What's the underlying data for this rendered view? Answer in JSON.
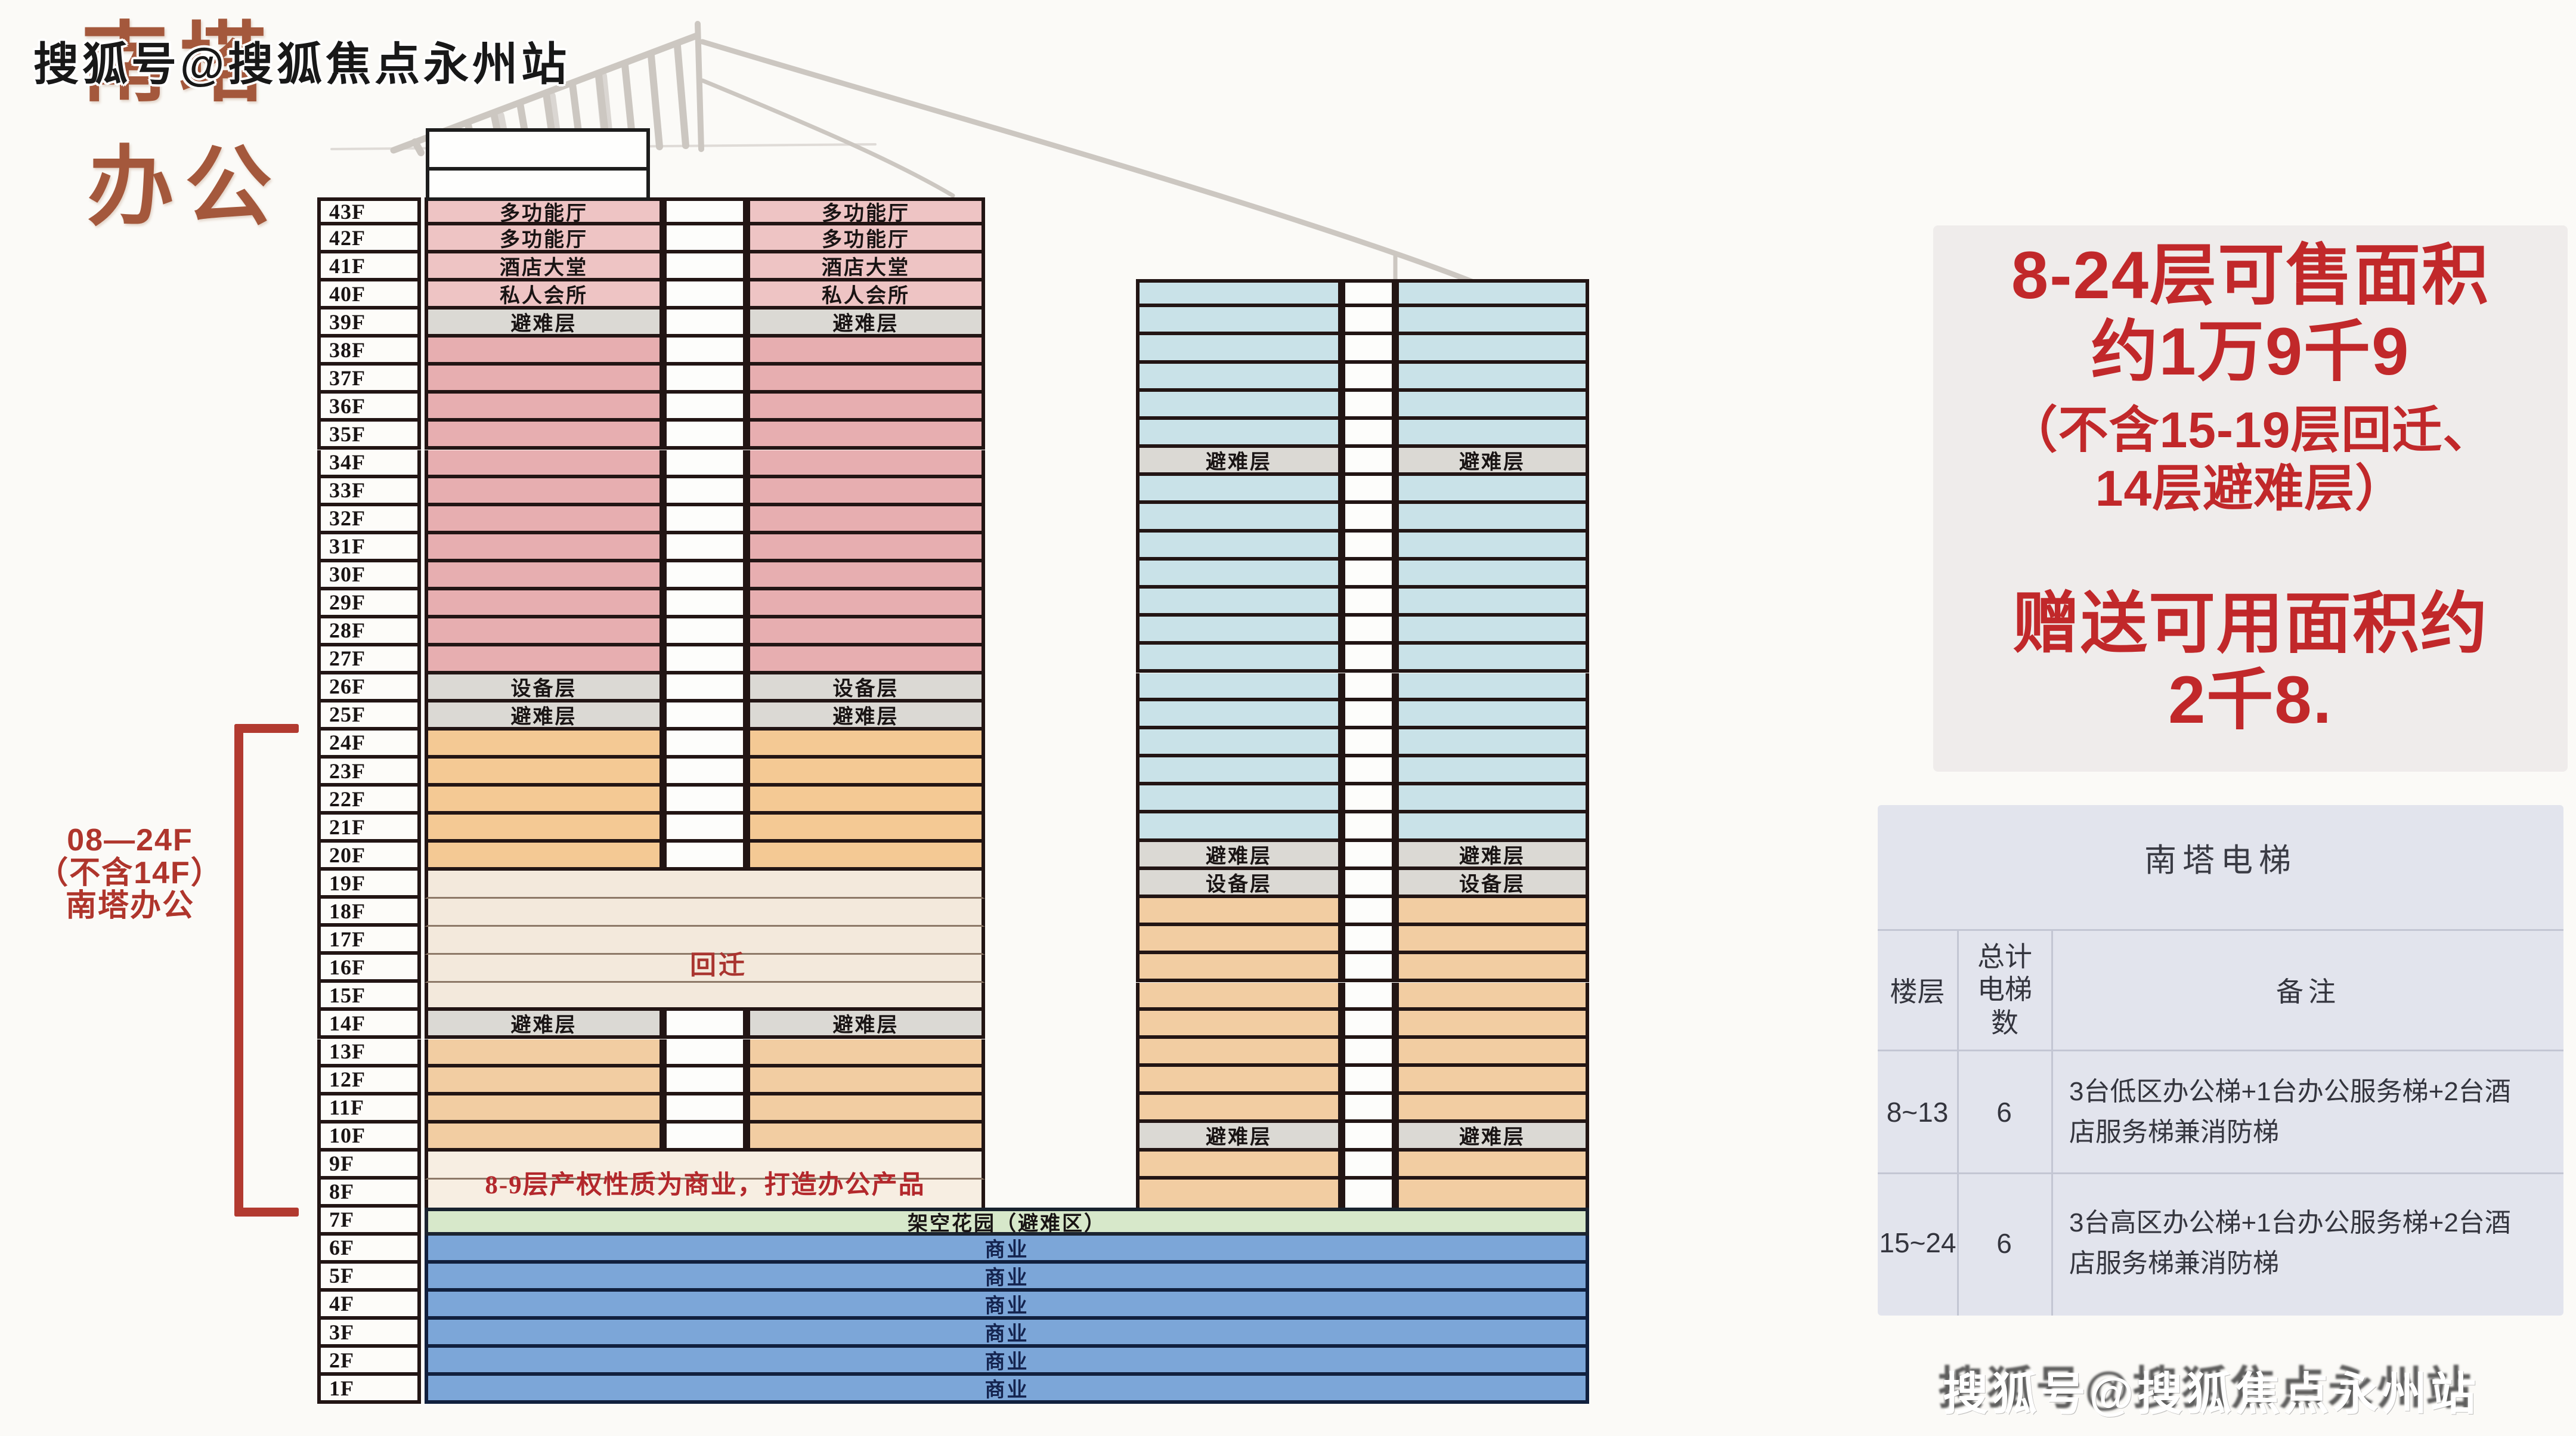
{
  "watermarks": {
    "top": "搜狐号@搜狐焦点永州站",
    "bottom": "搜狐号@搜狐焦点永州站"
  },
  "title": {
    "line1": "南塔",
    "line2": "办公"
  },
  "bracket": {
    "lines": [
      "08—24F",
      "（不含14F）",
      "南塔办公"
    ]
  },
  "overlays": {
    "huiqian": "回迁",
    "note_8_9": "8-9层产权性质为商业，打造办公产品"
  },
  "palette": {
    "border_dark": "#221514",
    "blue_border": "#11203e",
    "gap_white": "#fdfdfb",
    "pink": "#e7aeb0",
    "pink_light": "#eec4c4",
    "gray_row": "#dbd9d4",
    "orange": "#f4c994",
    "orange2": "#f2cda2",
    "beige": "#f3e9dc",
    "beige2": "#f7eee2",
    "cyan": "#c9e2e8",
    "green": "#d7e8ca",
    "blue": "#7ca6d8",
    "red_note": "#c1282a",
    "red_bracket": "#b23a30",
    "title_brown": "#a4583c",
    "beige_divider": "#8d7968"
  },
  "left_tower": {
    "floors": [
      {
        "label": "43F",
        "type": "split",
        "color": "pink_light",
        "text": "多功能厅"
      },
      {
        "label": "42F",
        "type": "split",
        "color": "pink_light",
        "text": "多功能厅"
      },
      {
        "label": "41F",
        "type": "split",
        "color": "pink_light",
        "text": "酒店大堂"
      },
      {
        "label": "40F",
        "type": "split",
        "color": "pink_light",
        "text": "私人会所"
      },
      {
        "label": "39F",
        "type": "split",
        "color": "gray_row",
        "text": "避难层"
      },
      {
        "label": "38F",
        "type": "split",
        "color": "pink",
        "text": ""
      },
      {
        "label": "37F",
        "type": "split",
        "color": "pink",
        "text": ""
      },
      {
        "label": "36F",
        "type": "split",
        "color": "pink",
        "text": ""
      },
      {
        "label": "35F",
        "type": "split",
        "color": "pink",
        "text": ""
      },
      {
        "label": "34F",
        "type": "split",
        "color": "pink",
        "text": ""
      },
      {
        "label": "33F",
        "type": "split",
        "color": "pink",
        "text": ""
      },
      {
        "label": "32F",
        "type": "split",
        "color": "pink",
        "text": ""
      },
      {
        "label": "31F",
        "type": "split",
        "color": "pink",
        "text": ""
      },
      {
        "label": "30F",
        "type": "split",
        "color": "pink",
        "text": ""
      },
      {
        "label": "29F",
        "type": "split",
        "color": "pink",
        "text": ""
      },
      {
        "label": "28F",
        "type": "split",
        "color": "pink",
        "text": ""
      },
      {
        "label": "27F",
        "type": "split",
        "color": "pink",
        "text": ""
      },
      {
        "label": "26F",
        "type": "split",
        "color": "gray_row",
        "text": "设备层"
      },
      {
        "label": "25F",
        "type": "split",
        "color": "gray_row",
        "text": "避难层"
      },
      {
        "label": "24F",
        "type": "split",
        "color": "orange",
        "text": ""
      },
      {
        "label": "23F",
        "type": "split",
        "color": "orange",
        "text": ""
      },
      {
        "label": "22F",
        "type": "split",
        "color": "orange",
        "text": ""
      },
      {
        "label": "21F",
        "type": "split",
        "color": "orange",
        "text": ""
      },
      {
        "label": "20F",
        "type": "split",
        "color": "orange",
        "text": ""
      },
      {
        "label": "19F",
        "type": "merged",
        "color": "beige",
        "text": ""
      },
      {
        "label": "18F",
        "type": "merged",
        "color": "beige",
        "text": ""
      },
      {
        "label": "17F",
        "type": "merged",
        "color": "beige",
        "text": ""
      },
      {
        "label": "16F",
        "type": "merged",
        "color": "beige",
        "text": ""
      },
      {
        "label": "15F",
        "type": "merged",
        "color": "beige",
        "text": ""
      },
      {
        "label": "14F",
        "type": "split",
        "color": "gray_row",
        "text": "避难层"
      },
      {
        "label": "13F",
        "type": "split",
        "color": "orange2",
        "text": ""
      },
      {
        "label": "12F",
        "type": "split",
        "color": "orange2",
        "text": ""
      },
      {
        "label": "11F",
        "type": "split",
        "color": "orange2",
        "text": ""
      },
      {
        "label": "10F",
        "type": "split",
        "color": "orange2",
        "text": ""
      },
      {
        "label": "9F",
        "type": "merged",
        "color": "beige2",
        "text": ""
      },
      {
        "label": "8F",
        "type": "merged",
        "color": "beige2",
        "text": ""
      },
      {
        "label": "7F",
        "type": "wide",
        "color": "green",
        "text": "架空花园（避难区）"
      },
      {
        "label": "6F",
        "type": "wide",
        "color": "blue",
        "text": "商业"
      },
      {
        "label": "5F",
        "type": "wide",
        "color": "blue",
        "text": "商业"
      },
      {
        "label": "4F",
        "type": "wide",
        "color": "blue",
        "text": "商业"
      },
      {
        "label": "3F",
        "type": "wide",
        "color": "blue",
        "text": "商业"
      },
      {
        "label": "2F",
        "type": "wide",
        "color": "blue",
        "text": "商业"
      },
      {
        "label": "1F",
        "type": "wide",
        "color": "blue",
        "text": "商业"
      }
    ]
  },
  "right_tower": {
    "rows": [
      {
        "color": "cyan",
        "text": ""
      },
      {
        "color": "cyan",
        "text": ""
      },
      {
        "color": "cyan",
        "text": ""
      },
      {
        "color": "cyan",
        "text": ""
      },
      {
        "color": "cyan",
        "text": ""
      },
      {
        "color": "cyan",
        "text": ""
      },
      {
        "color": "gray_row",
        "text": "避难层"
      },
      {
        "color": "cyan",
        "text": ""
      },
      {
        "color": "cyan",
        "text": ""
      },
      {
        "color": "cyan",
        "text": ""
      },
      {
        "color": "cyan",
        "text": ""
      },
      {
        "color": "cyan",
        "text": ""
      },
      {
        "color": "cyan",
        "text": ""
      },
      {
        "color": "cyan",
        "text": ""
      },
      {
        "color": "cyan",
        "text": ""
      },
      {
        "color": "cyan",
        "text": ""
      },
      {
        "color": "cyan",
        "text": ""
      },
      {
        "color": "cyan",
        "text": ""
      },
      {
        "color": "cyan",
        "text": ""
      },
      {
        "color": "cyan",
        "text": ""
      },
      {
        "color": "gray_row",
        "text": "避难层"
      },
      {
        "color": "gray_row",
        "text": "设备层"
      },
      {
        "color": "orange2",
        "text": ""
      },
      {
        "color": "orange2",
        "text": ""
      },
      {
        "color": "orange2",
        "text": ""
      },
      {
        "color": "orange2",
        "text": ""
      },
      {
        "color": "orange2",
        "text": ""
      },
      {
        "color": "orange2",
        "text": ""
      },
      {
        "color": "orange2",
        "text": ""
      },
      {
        "color": "orange2",
        "text": ""
      },
      {
        "color": "gray_row",
        "text": "避难层"
      },
      {
        "color": "orange2",
        "text": ""
      },
      {
        "color": "orange2",
        "text": ""
      }
    ]
  },
  "sales_note": {
    "lines": [
      "8-24层可售面积",
      "约1万9千9",
      "（不含15-19层回迁、",
      "14层避难层）",
      "赠送可用面积约",
      "2千8."
    ]
  },
  "elevator": {
    "title": "南塔电梯",
    "headers": [
      "楼层",
      "总计电梯数",
      "备注"
    ],
    "rows": [
      {
        "floors": "8~13",
        "count": "6",
        "note": "3台低区办公梯+1台办公服务梯+2台酒店服务梯兼消防梯"
      },
      {
        "floors": "15~24",
        "count": "6",
        "note": "3台高区办公梯+1台办公服务梯+2台酒店服务梯兼消防梯"
      }
    ]
  }
}
